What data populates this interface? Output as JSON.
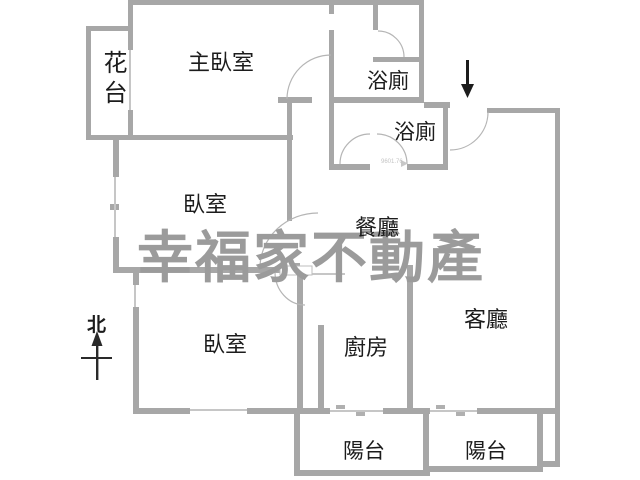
{
  "watermark": "幸福家不動產",
  "compass": {
    "north_label": "北"
  },
  "entry": {
    "arrow": "down-arrow"
  },
  "rooms": {
    "master_bedroom": "主臥室",
    "flower_bed": "花台",
    "bathroom_upper": "浴廁",
    "bathroom_lower": "浴廁",
    "bedroom_middle": "臥室",
    "bedroom_lower": "臥室",
    "dining": "餐廳",
    "kitchen": "廚房",
    "living": "客廳",
    "balcony_left": "陽台",
    "balcony_right": "陽台"
  },
  "annotations": {
    "dimension_note": "9601.76"
  },
  "colors": {
    "wall": "#a7a7a7",
    "window_line": "#c6c6c6",
    "door_arc": "#b5b5b5",
    "text": "#1c1c1c",
    "watermark": "#9b9b9b"
  }
}
